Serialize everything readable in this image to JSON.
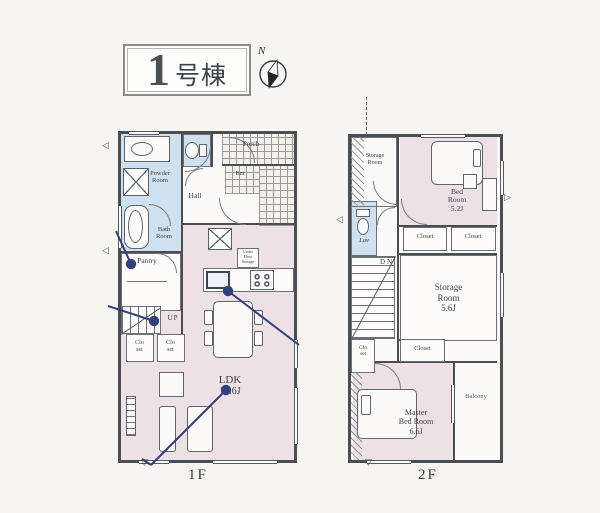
{
  "title": {
    "number": "1",
    "suffix": "号棟"
  },
  "compass": {
    "north_label": "N"
  },
  "glyphs": {
    "tri_left": "◁",
    "tri_right": "▷",
    "tri_down": "▽"
  },
  "colors": {
    "annotation": "#333f7e",
    "wall": "#4a4e53",
    "room_pink": "#ede1e6",
    "room_blue": "#cfe1ee",
    "tile_bg": "#f3f0ec",
    "paper": "#fbfaf8"
  },
  "floor1": {
    "label": "1F",
    "rooms": {
      "powder_room": "Powder\nRoom",
      "bath_room": "Bath\nRoom",
      "hall": "Hall",
      "porch": "Porch",
      "entrance": "Ent",
      "pantry": "Pantry",
      "stairs": "UP",
      "closet_a": "Clo\nset",
      "closet_b": "Clo\nset",
      "under_floor_storage": "Under\nFloor\nStorage",
      "ldk": "LDK",
      "ldk_size": "18.6J"
    }
  },
  "floor2": {
    "label": "2F",
    "rooms": {
      "storage_room_small": "Storage\nRoom",
      "bed_room": "Bed\nRoom",
      "bed_room_size": "5.2J",
      "closet_a": "Closet",
      "closet_b": "Closet",
      "lavatory": "Lav",
      "stairs": "DN",
      "storage_room": "Storage\nRoom",
      "storage_room_size": "5.6J",
      "closet_small": "Clo\nset",
      "closet_c": "Closet",
      "master_bed_room": "Master\nBed Room",
      "master_bed_room_size": "6.6J",
      "balcony": "Balcony"
    }
  }
}
